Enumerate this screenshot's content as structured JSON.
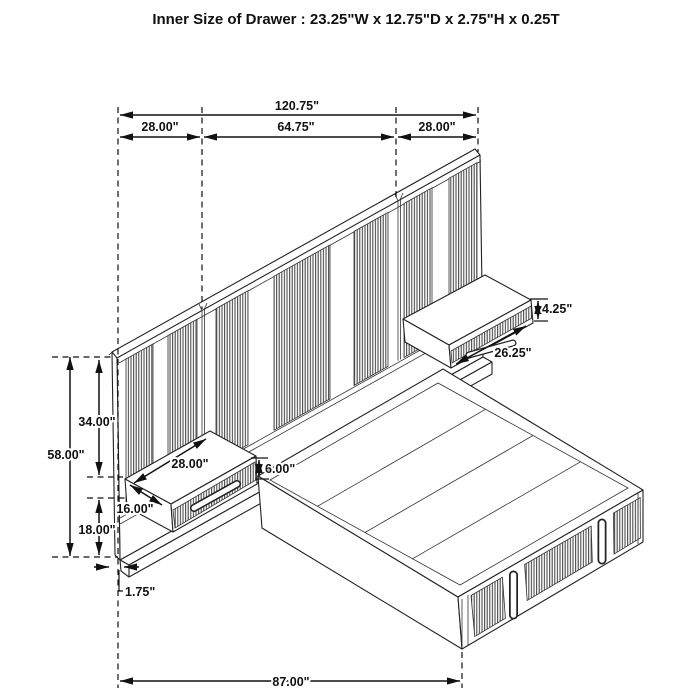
{
  "title": "Inner Size of Drawer : 23.25\"W x 12.75\"D x 2.75\"H x 0.25T",
  "dims": {
    "total_width": "120.75\"",
    "left_section": "28.00\"",
    "center_section": "64.75\"",
    "right_section": "28.00\"",
    "headboard_height": "58.00\"",
    "upper_height": "34.00\"",
    "lower_height": "18.00\"",
    "panel_thickness": "1.75\"",
    "bed_length": "87.00\"",
    "right_nightstand_height": "4.25\"",
    "right_nightstand_width": "26.25\"",
    "left_nightstand_width": "28.00\"",
    "left_nightstand_height": "6.00\"",
    "left_nightstand_depth": "16.00\"",
    "colors": {
      "line": "#111111",
      "rib": "#4d4d4d",
      "background": "#ffffff"
    }
  }
}
